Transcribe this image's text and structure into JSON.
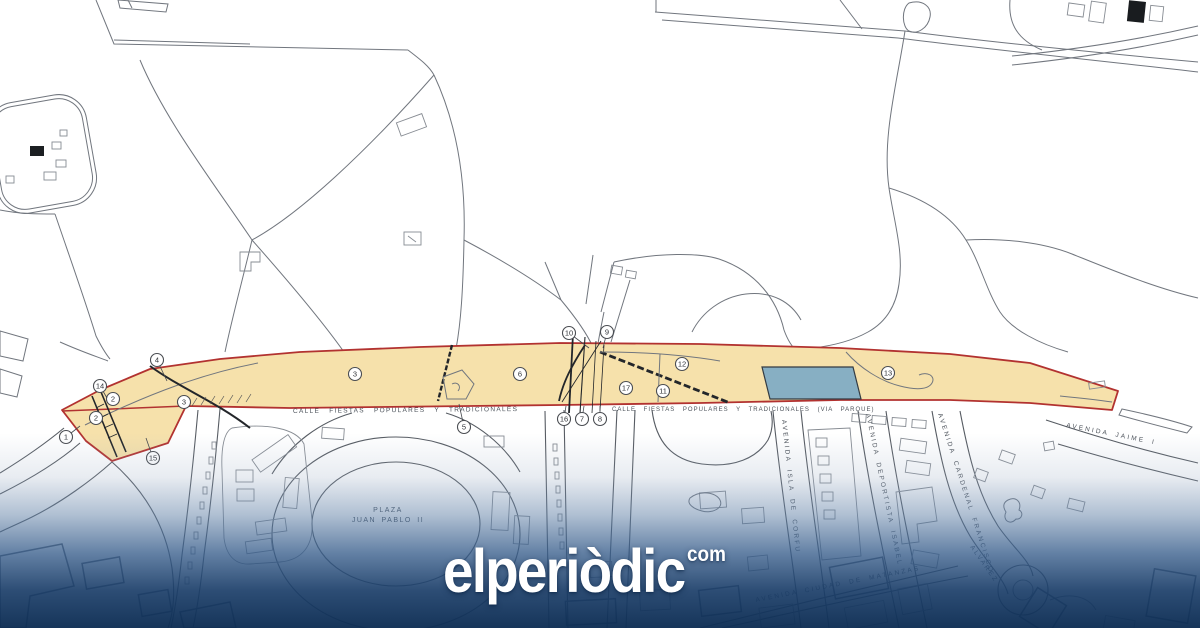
{
  "watermark": {
    "brand": "elperiòdic",
    "tld": "com"
  },
  "map": {
    "colors": {
      "corridor_fill": "#F6E1AB",
      "corridor_outline": "#B23230",
      "water_fill": "#87AFC3",
      "overlay_navy": "#17375F",
      "line_gray": "#71767E"
    },
    "street_labels": [
      {
        "name": "label-calle-fiestas-west",
        "text": "CALLE FIESTAS POPULARES Y TRADICIONALES",
        "x": 293,
        "y": 413,
        "rot": -0.5,
        "cls": "street-xs"
      },
      {
        "name": "label-calle-fiestas-east",
        "text": "CALLE FIESTAS POPULARES Y TRADICIONALES (VIA PARQUE)",
        "x": 612,
        "y": 411,
        "rot": 0,
        "cls": "street-xxs"
      },
      {
        "name": "label-plaza-line1",
        "text": "PLAZA",
        "x": 388,
        "y": 512,
        "rot": 0,
        "cls": "street-md"
      },
      {
        "name": "label-plaza-line2",
        "text": "JUAN PABLO II",
        "x": 388,
        "y": 522,
        "rot": 0,
        "cls": "street-md"
      },
      {
        "name": "label-avenida-isla-de-corfu",
        "text": "AVENIDA ISLA DE CORFU",
        "x": 782,
        "y": 420,
        "rot": 84,
        "cls": "street-av"
      },
      {
        "name": "label-avenida-deportista-isabel",
        "text": "AVENIDA DEPORTISTA ISABEL",
        "x": 866,
        "y": 414,
        "rot": 78,
        "cls": "street-av"
      },
      {
        "name": "label-avenida-cardenal-francisco",
        "text": "AVENIDA CARDENAL FRANCISCO",
        "x": 938,
        "y": 414,
        "rot": 72,
        "cls": "street-av"
      },
      {
        "name": "label-alvarez",
        "text": "ALVAREZ",
        "x": 970,
        "y": 547,
        "rot": 55,
        "cls": "street-av"
      },
      {
        "name": "label-avenida-ciudad-de-matanzas",
        "text": "AVENIDA CIUDAD DE MATANZAS",
        "x": 756,
        "y": 602,
        "rot": -11,
        "cls": "street-av"
      },
      {
        "name": "label-avenida-jaime",
        "text": "AVENIDA JAIME I",
        "x": 1066,
        "y": 427,
        "rot": 11,
        "cls": "street-av"
      }
    ],
    "markers": [
      {
        "label": "1",
        "x": 66,
        "y": 437,
        "lx": 80,
        "ly": 426
      },
      {
        "label": "2",
        "x": 113,
        "y": 399
      },
      {
        "label": "2",
        "x": 96,
        "y": 418
      },
      {
        "label": "14",
        "x": 100,
        "y": 386,
        "lx": 107,
        "ly": 398
      },
      {
        "label": "4",
        "x": 157,
        "y": 360,
        "lx": 167,
        "ly": 381
      },
      {
        "label": "3",
        "x": 184,
        "y": 402
      },
      {
        "label": "15",
        "x": 153,
        "y": 458,
        "lx": 146,
        "ly": 438
      },
      {
        "label": "3",
        "x": 355,
        "y": 374
      },
      {
        "label": "5",
        "x": 464,
        "y": 427,
        "lx": 459,
        "ly": 404
      },
      {
        "label": "6",
        "x": 520,
        "y": 374
      },
      {
        "label": "10",
        "x": 569,
        "y": 333,
        "lx": 589,
        "ly": 348
      },
      {
        "label": "9",
        "x": 607,
        "y": 332,
        "lx": 603,
        "ly": 348
      },
      {
        "label": "16",
        "x": 564,
        "y": 419,
        "lx": 566,
        "ly": 406
      },
      {
        "label": "7",
        "x": 582,
        "y": 419,
        "lx": 584,
        "ly": 406
      },
      {
        "label": "8",
        "x": 600,
        "y": 419,
        "lx": 600,
        "ly": 406
      },
      {
        "label": "17",
        "x": 626,
        "y": 388
      },
      {
        "label": "11",
        "x": 663,
        "y": 391
      },
      {
        "label": "12",
        "x": 682,
        "y": 364
      },
      {
        "label": "13",
        "x": 888,
        "y": 373
      }
    ]
  }
}
